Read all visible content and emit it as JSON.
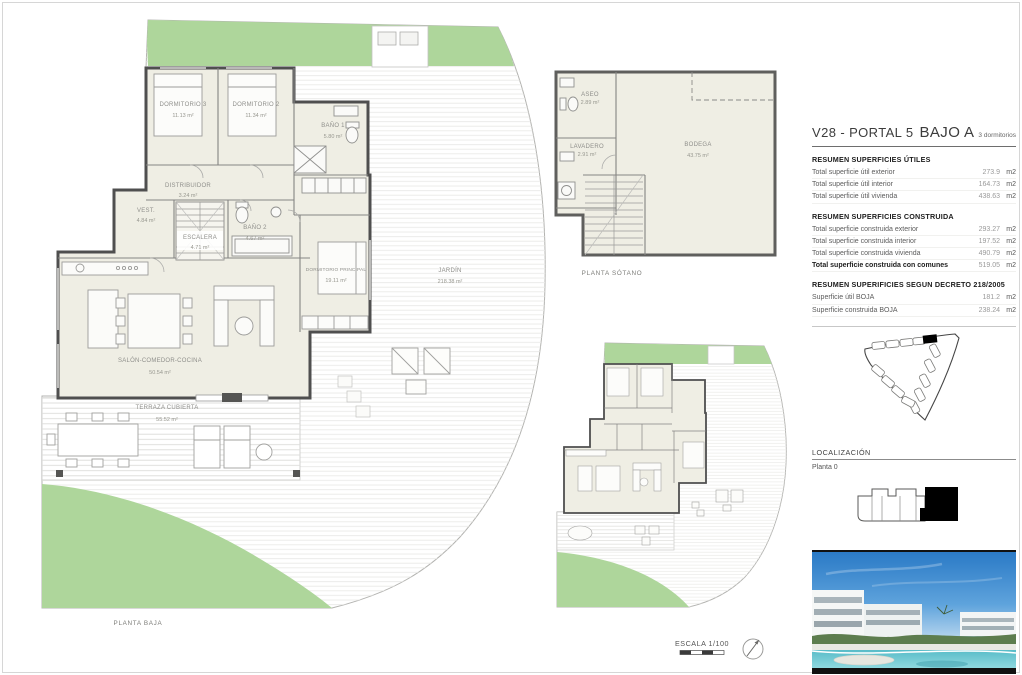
{
  "sheet": {
    "header": {
      "code": "V28 - PORTAL 5",
      "unit": "BAJO A",
      "subtitle": "3 dormitorios"
    },
    "sections": {
      "utiles": {
        "title": "RESUMEN SUPERFICIES ÚTILES",
        "rows": [
          {
            "label": "Total superficie útil exterior",
            "value": "273.9",
            "unit": "m2"
          },
          {
            "label": "Total superficie útil interior",
            "value": "164.73",
            "unit": "m2"
          },
          {
            "label": "Total superficie útil vivienda",
            "value": "438.63",
            "unit": "m2"
          }
        ]
      },
      "construida": {
        "title": "RESUMEN SUPERFICIES CONSTRUIDA",
        "rows": [
          {
            "label": "Total superficie construida exterior",
            "value": "293.27",
            "unit": "m2"
          },
          {
            "label": "Total superficie construida interior",
            "value": "197.52",
            "unit": "m2"
          },
          {
            "label": "Total superficie construida vivienda",
            "value": "490.79",
            "unit": "m2"
          },
          {
            "label": "Total superficie construida con comunes",
            "value": "519.05",
            "unit": "m2"
          }
        ]
      },
      "decreto": {
        "title": "RESUMEN SUPERIFICIES SEGUN DECRETO 218/2005",
        "rows": [
          {
            "label": "Superficie útil BOJA",
            "value": "181.2",
            "unit": "m2"
          },
          {
            "label": "Superficie construida BOJA",
            "value": "238.24",
            "unit": "m2"
          }
        ]
      }
    },
    "localizacion": {
      "title": "LOCALIZACIÓN",
      "planta": "Planta 0"
    }
  },
  "plan_main": {
    "caption": "PLANTA BAJA",
    "rooms": [
      {
        "name": "DORMITORIO 3",
        "area": "11.13 m²"
      },
      {
        "name": "DORMITORIO 2",
        "area": "11.34 m²"
      },
      {
        "name": "BAÑO 1",
        "area": "5.80 m²"
      },
      {
        "name": "DISTRIBUIDOR",
        "area": "3.24 m²"
      },
      {
        "name": "VEST.",
        "area": "4.84 m²"
      },
      {
        "name": "ESCALERA",
        "area": "4.71 m²"
      },
      {
        "name": "BAÑO 2",
        "area": "4.67 m²"
      },
      {
        "name": "DORMITORIO PRINCIPAL",
        "area": "19.11 m²"
      },
      {
        "name": "SALÓN-COMEDOR-COCINA",
        "area": "50.54 m²"
      },
      {
        "name": "TERRAZA CUBIERTA",
        "area": "55.52 m²"
      },
      {
        "name": "JARDÍN",
        "area": "218.38 m²"
      }
    ]
  },
  "plan_sotano": {
    "caption": "PLANTA SÓTANO",
    "rooms": [
      {
        "name": "ASEO",
        "area": "2.89 m²"
      },
      {
        "name": "LAVADERO",
        "area": "2.91 m²"
      },
      {
        "name": "BODEGA",
        "area": "43.75 m²"
      }
    ]
  },
  "scale": {
    "label": "ESCALA 1/100"
  },
  "colors": {
    "green": "#aed69b",
    "room": "#efeee4",
    "wall": "#4f4f4f",
    "black": "#000000"
  }
}
